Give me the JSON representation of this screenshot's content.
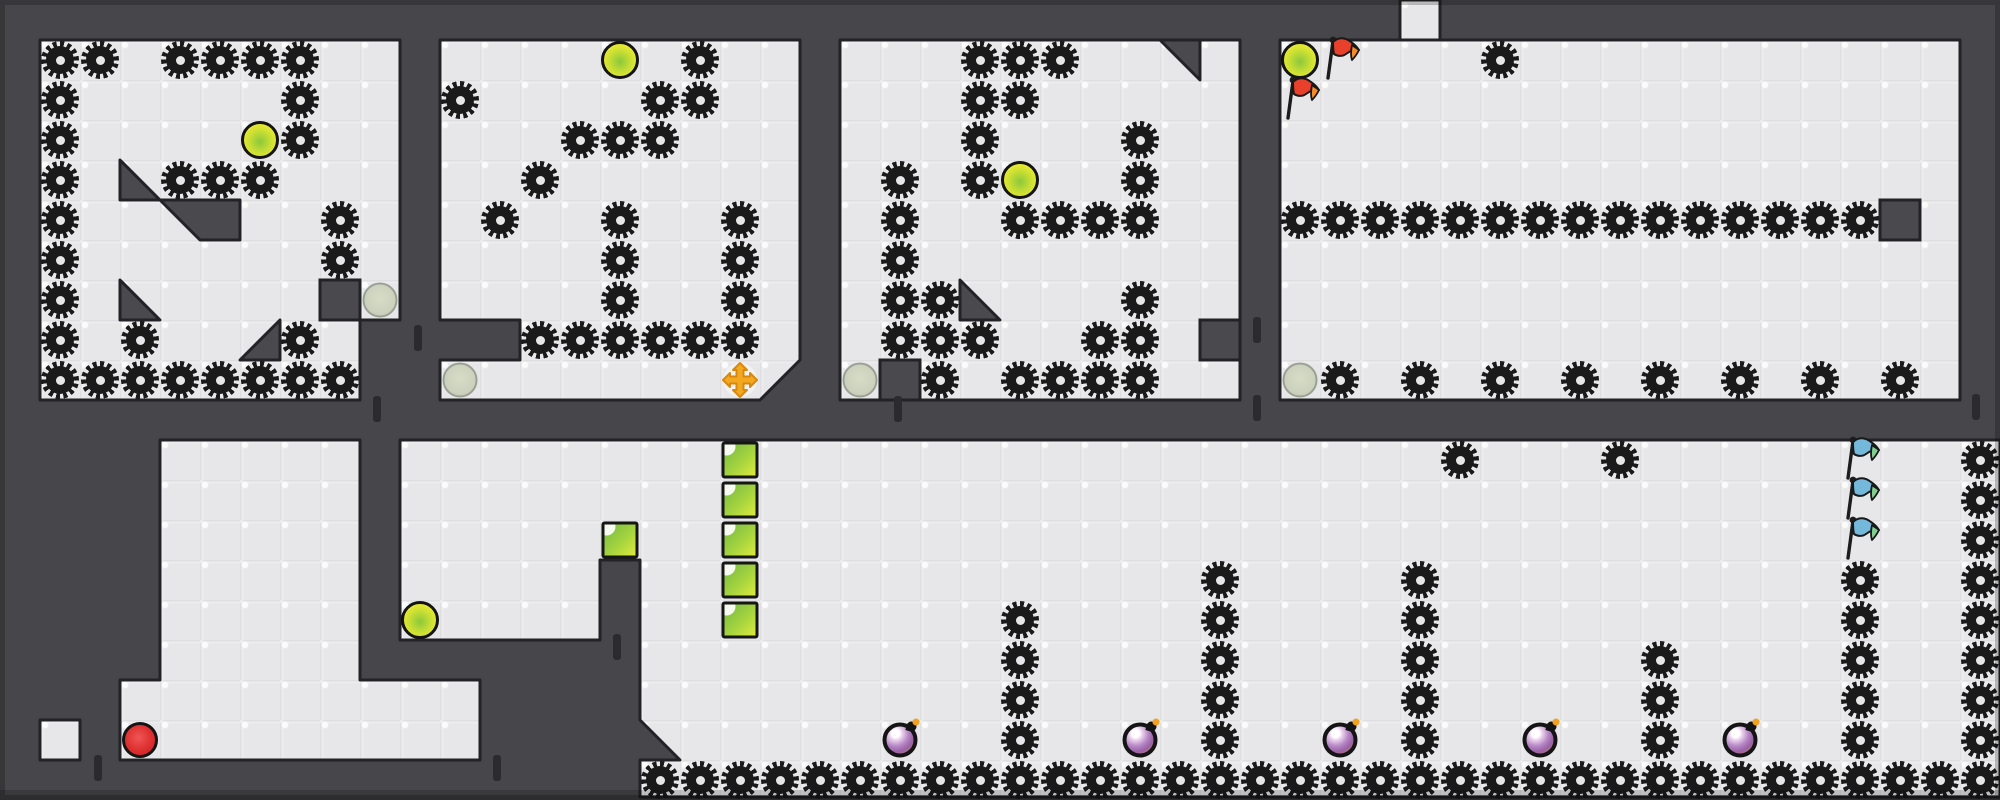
{
  "grid": {
    "tile": 40,
    "cols": 50,
    "rows": 20,
    "width": 2000,
    "height": 800
  },
  "palette": {
    "wall": "#47474b",
    "wall_dark": "#232327",
    "wall_piece": "#4a4a4e",
    "door": "#2b2b2f",
    "floor": "#e7e7e9",
    "saw": "#1a1a1a",
    "ball_yellow": "#edec2f",
    "ball_yellow_core": "#8cc83c",
    "ball_gray": "#ccd2bd",
    "ball_red": "#dd2f2f",
    "bomb_body": "#9a63a6",
    "bomb_warm": "#c57a5e",
    "bomb_spark": "#f4a11d",
    "green_block_a": "#79bd42",
    "green_block_b": "#dcea3c",
    "flag_red": "#e8402a",
    "flag_red_tip": "#f58b29",
    "flag_blue": "#74b8dc",
    "flag_blue_tip": "#83cf92",
    "cross": "#f3a820",
    "cross_edge": "#d8880f"
  },
  "floors": [
    {
      "name": "room-1",
      "poly": "40,40 400,40 400,320 360,320 360,400 40,400"
    },
    {
      "name": "room-2",
      "poly": "440,40 800,40 800,360 760,400 440,400 440,360 520,360 520,320 440,320"
    },
    {
      "name": "room-3",
      "poly": "840,40 1240,40 1240,400 840,400"
    },
    {
      "name": "room-4",
      "poly": "1280,40 1960,40 1960,400 1280,400"
    },
    {
      "name": "top-shaft",
      "poly": "1400,0 1440,0 1440,40 1400,40"
    },
    {
      "name": "pocket-shaft-and-band",
      "poly": "160,440 360,440 360,680 480,680 480,760 120,760 120,680 160,680"
    },
    {
      "name": "isolated-tile",
      "poly": "40,720 80,720 80,760 40,760"
    },
    {
      "name": "bottom-room",
      "poly": "400,440 2000,440 2000,797 640,797 640,760 680,760 640,720 640,560 600,560 600,640 400,640"
    }
  ],
  "wall_triangles": [
    {
      "name": "slope-room1-a",
      "pts": "120,160 160,200 120,200"
    },
    {
      "name": "slope-room1-b",
      "pts": "120,280 160,320 120,320"
    },
    {
      "name": "slope-room1-c",
      "pts": "280,320 280,360 240,360"
    },
    {
      "name": "slope-room3-corner",
      "pts": "1160,40 1200,40 1200,80"
    },
    {
      "name": "slope-room3-floor",
      "pts": "960,280 1000,320 960,320"
    }
  ],
  "wall_chunks": [
    {
      "name": "slope-block-room1",
      "pts": "160,200 240,200 240,240 200,240"
    }
  ],
  "wall_blocks": [
    [
      320,
      280
    ],
    [
      880,
      360
    ],
    [
      1200,
      320
    ],
    [
      1880,
      200
    ]
  ],
  "door_markers": [
    [
      414,
      325
    ],
    [
      373,
      396
    ],
    [
      894,
      396
    ],
    [
      1253,
      317
    ],
    [
      1253,
      395
    ],
    [
      1972,
      394
    ],
    [
      613,
      634
    ],
    [
      94,
      755
    ],
    [
      493,
      755
    ]
  ],
  "saw_rows": [
    {
      "r": 1,
      "cols": [
        1,
        2,
        4,
        5,
        6,
        7,
        17,
        24,
        25,
        26,
        37
      ]
    },
    {
      "r": 2,
      "cols": [
        1,
        7,
        11,
        16,
        17,
        24,
        25
      ]
    },
    {
      "r": 3,
      "cols": [
        1,
        7,
        14,
        15,
        16,
        24,
        28
      ]
    },
    {
      "r": 4,
      "cols": [
        1,
        4,
        5,
        6,
        13,
        22,
        24,
        28
      ]
    },
    {
      "r": 5,
      "cols": [
        1,
        8,
        12,
        15,
        18,
        22,
        25,
        26,
        27,
        28,
        32,
        33,
        34,
        35,
        36,
        37,
        38,
        39,
        40,
        41,
        42,
        43,
        44,
        45,
        46
      ]
    },
    {
      "r": 6,
      "cols": [
        1,
        8,
        15,
        18,
        22
      ]
    },
    {
      "r": 7,
      "cols": [
        1,
        15,
        18,
        22,
        23,
        28
      ]
    },
    {
      "r": 8,
      "cols": [
        1,
        3,
        7,
        13,
        14,
        15,
        16,
        17,
        18,
        22,
        23,
        24,
        27,
        28
      ]
    },
    {
      "r": 9,
      "cols": [
        1,
        2,
        3,
        4,
        5,
        6,
        7,
        8,
        23,
        25,
        26,
        27,
        28,
        33,
        35,
        37,
        39,
        41,
        43,
        45,
        47
      ]
    },
    {
      "r": 11,
      "cols": [
        36,
        40,
        49
      ]
    },
    {
      "r": 12,
      "cols": [
        49
      ]
    },
    {
      "r": 13,
      "cols": [
        49
      ]
    },
    {
      "r": 14,
      "cols": [
        30,
        35,
        46,
        49
      ]
    },
    {
      "r": 15,
      "cols": [
        25,
        30,
        35,
        46,
        49
      ]
    },
    {
      "r": 16,
      "cols": [
        25,
        30,
        35,
        41,
        46,
        49
      ]
    },
    {
      "r": 17,
      "cols": [
        25,
        30,
        35,
        41,
        46,
        49
      ]
    },
    {
      "r": 18,
      "cols": [
        25,
        30,
        35,
        41,
        46,
        49
      ]
    },
    {
      "r": 19,
      "from": 16,
      "to": 49
    }
  ],
  "balls_yellow": [
    [
      6,
      3
    ],
    [
      15,
      1
    ],
    [
      25,
      4
    ],
    [
      32,
      1
    ],
    [
      10,
      15
    ]
  ],
  "balls_gray": [
    [
      9,
      7
    ],
    [
      11,
      9
    ],
    [
      21,
      9
    ],
    [
      32,
      9
    ]
  ],
  "balls_red": [
    [
      3,
      18
    ]
  ],
  "bombs": [
    [
      22,
      18
    ],
    [
      28,
      18
    ],
    [
      33,
      18
    ],
    [
      38,
      18
    ],
    [
      43,
      18
    ]
  ],
  "green_blocks": [
    [
      15,
      13
    ],
    [
      18,
      11
    ],
    [
      18,
      12
    ],
    [
      18,
      13
    ],
    [
      18,
      14
    ],
    [
      18,
      15
    ]
  ],
  "flags_red": [
    [
      33,
      1
    ],
    [
      32,
      2
    ]
  ],
  "flags_blue": [
    [
      46,
      11
    ],
    [
      46,
      12
    ],
    [
      46,
      13
    ]
  ],
  "crosses": [
    [
      18,
      9
    ]
  ]
}
